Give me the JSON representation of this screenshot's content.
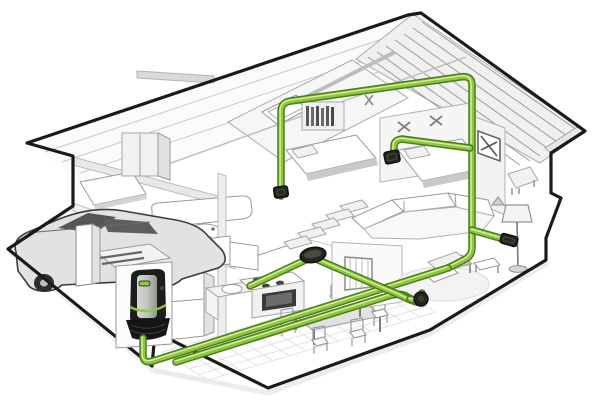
{
  "title": "Cutaway house illustration of a central vacuum system",
  "colors": {
    "background": "#ffffff",
    "outline": "#1a1a1a",
    "shadow": "#d9d9d9",
    "lineart": "#9a9a9a",
    "lineart_light": "#d2d2d2",
    "roof_fill": "#fbfbfb",
    "roof_right_fill": "#f0f0f0",
    "pipe_outer": "#4b7c1d",
    "pipe_core": "#8dc63f",
    "pipe_highlight": "#ddf3a6",
    "inlet_dark": "#26261f",
    "inlet_edge": "#0e0e0c",
    "unit_body": "#1d1d1d",
    "unit_boot": "#151515",
    "unit_panel_light": "#cdd1cd",
    "unit_panel_dark": "#969c96",
    "unit_led": "#8dc63f",
    "window_dark": "#3a3a3a",
    "burner_dark": "#444444",
    "car_fill": "#e2e2e2",
    "car_line": "#3c3c3c",
    "car_glass": "#555555",
    "tile_line": "#e3e3e3"
  },
  "vacuum_system": {
    "power_unit": {
      "name": "central-vacuum-power-unit",
      "x": 127,
      "y": 268
    },
    "pipes": [
      {
        "name": "pipe-attic-trunk",
        "d": "M 281,196 L 281,112 Q 281,102 291,101 L 460,77 Q 472,75 472,85 L 472,248 Q 472,256 464,260 L 448,268"
      },
      {
        "name": "pipe-floor-main",
        "d": "M 143,338 L 143,355 Q 143,364 153,361 L 448,268"
      },
      {
        "name": "pipe-floor-parallel",
        "d": "M 176,362 L 382,298 Q 398,292 406,296 L 417,302"
      },
      {
        "name": "pipe-disc-to-elbow",
        "d": "M 316,259 L 402,296 Q 410,300 416,302"
      },
      {
        "name": "pipe-disc-spur",
        "d": "M 310,258 L 250,286"
      },
      {
        "name": "pipe-bedroom-right-branch",
        "d": "M 394,152 L 394,146 Q 394,140 402,139 L 470,148"
      },
      {
        "name": "pipe-lamp-branch",
        "d": "M 472,230 L 500,238"
      },
      {
        "name": "pipe-elbow-riser",
        "d": "M 410,299 Q 419,302 422,293"
      }
    ],
    "inlets": [
      {
        "name": "bedroom-left-wall-inlet",
        "shape": "rect",
        "x": 281,
        "y": 192,
        "w": 14,
        "h": 11,
        "rot": -8
      },
      {
        "name": "bedroom-right-wall-inlet",
        "shape": "rect",
        "x": 392,
        "y": 157,
        "w": 15,
        "h": 12,
        "rot": -12
      },
      {
        "name": "living-room-wall-inlet",
        "shape": "rect",
        "x": 509,
        "y": 240,
        "w": 17,
        "h": 10,
        "rot": 16
      },
      {
        "name": "hall-floor-inlet-disc",
        "shape": "ellipse",
        "x": 313,
        "y": 255,
        "w": 26,
        "h": 15,
        "rot": -10
      },
      {
        "name": "living-room-floor-elbow",
        "shape": "circle",
        "x": 421,
        "y": 299,
        "w": 14,
        "h": 14,
        "rot": 0
      }
    ]
  },
  "scene": {
    "rooms": [
      "garage",
      "kitchen",
      "dining-area",
      "living-room",
      "bathroom",
      "hallway-stairs",
      "bedroom-left",
      "bedroom-center",
      "bedroom-right",
      "kids-room",
      "attic"
    ],
    "objects": [
      "car",
      "garage-pillar",
      "central-vacuum-power-unit",
      "green-pipe-network",
      "refrigerator",
      "range-oven",
      "kitchen-sink-counter",
      "upper-cabinets",
      "dining-table",
      "dining-chairs",
      "sectional-sofa",
      "coffee-table",
      "floor-lamp",
      "area-rug",
      "lounge-chair",
      "side-table",
      "bed-center",
      "bed-right",
      "bed-far-left",
      "wardrobe",
      "bookshelf",
      "bathtub",
      "pedestal-sink",
      "staircase",
      "skylight",
      "roof-battens",
      "framed-x-picture",
      "wall-decals",
      "toy-dog",
      "kids-chair"
    ]
  }
}
